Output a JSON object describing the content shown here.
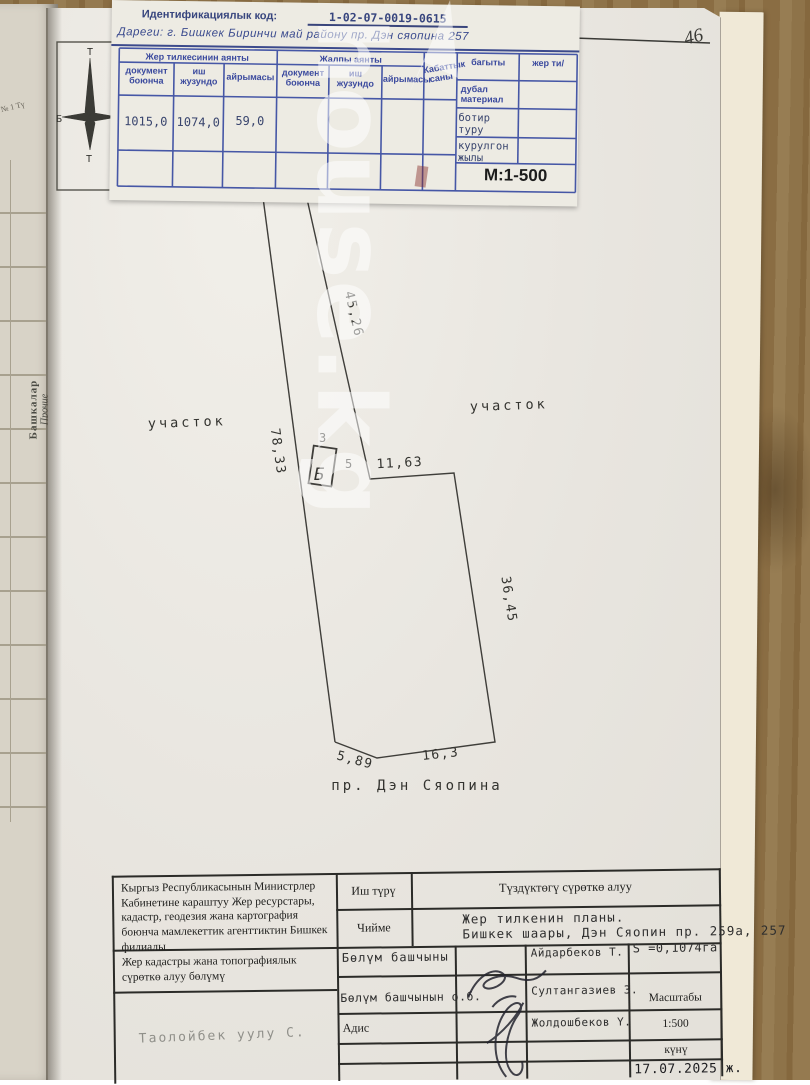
{
  "watermark": {
    "text": "house.kg"
  },
  "corner_scribble": "46",
  "side_notebook": {
    "tab_line1": "Башкалар",
    "tab_line2": "Прочие",
    "corner_text": "№ 1 Тү"
  },
  "compass": {
    "top": "Т",
    "left": "Б",
    "bottom": "Т"
  },
  "header_card": {
    "id_label": "Идентификациялык код:",
    "id_value": "1-02-07-0019-0615",
    "address": "Дареги: г. Бишкек Биринчи май району пр. Дэн сяопина 257",
    "scale_note": "М:1-500",
    "table": {
      "group1": "Жер тилкесинин аянты",
      "group2": "Жалпы аянты",
      "sub_doc": "документ боюнча",
      "sub_fact": "иш жузундо",
      "sub_diff": "айрымасы",
      "floors": "Кабаттык саны",
      "direction": "багыты",
      "wall_material": "дубал материал",
      "apt_type": "ботир туру",
      "year_built": "курулгон жылы",
      "land_col": "жер ти/",
      "values": {
        "doc": "1015,0",
        "fact": "1074,0",
        "diff": "59,0"
      }
    }
  },
  "plan": {
    "parcel_label": "участок",
    "street": "пр. Дэн Сяопина",
    "building_label": "Б",
    "building_width": "3",
    "building_length": "5",
    "dim_top_strip": "45,26",
    "dim_left": "78,33",
    "dim_notch": "11,63",
    "dim_right": "36,45",
    "dim_bottom_left": "5,89",
    "dim_bottom": "16,3"
  },
  "footer_table": {
    "agency": "Кыргыз Республикасынын Министрлер Кабинетине караштуу Жер ресурстары, кадастр, геодезия жана картография боюнча мамлекеттик агенттиктин Бишкек филиалы",
    "department": "Жер кадастры  жана топографиялык сүрөткө алуу бөлүмү",
    "handwritten_name": "Таолойбек  уулу  С.",
    "work_type_label": "Иш түрү",
    "work_type_value": "Түздүктөгү сүрөткө алуу",
    "drawing_label": "Чийме",
    "drawing_value_line1": "Жер тилкенин планы.",
    "drawing_value_line2": "Бишкек шаары, Дэн Сяопин пр. 259а, 257",
    "head_label": "Бөлүм башчыны",
    "head_name": "Айдарбеков Т.",
    "area_value": "S =0,1074га",
    "acting_head_label": "Бөлүм башчынын о.б.",
    "acting_head_name": "Султангазиев З.",
    "specialist_label": "Адис",
    "specialist_name": "Жолдошбеков Ү.",
    "scale_label": "Масштабы",
    "scale_value": "1:500",
    "date_label": "күнү",
    "date_value": "17.07.2025 ж."
  }
}
